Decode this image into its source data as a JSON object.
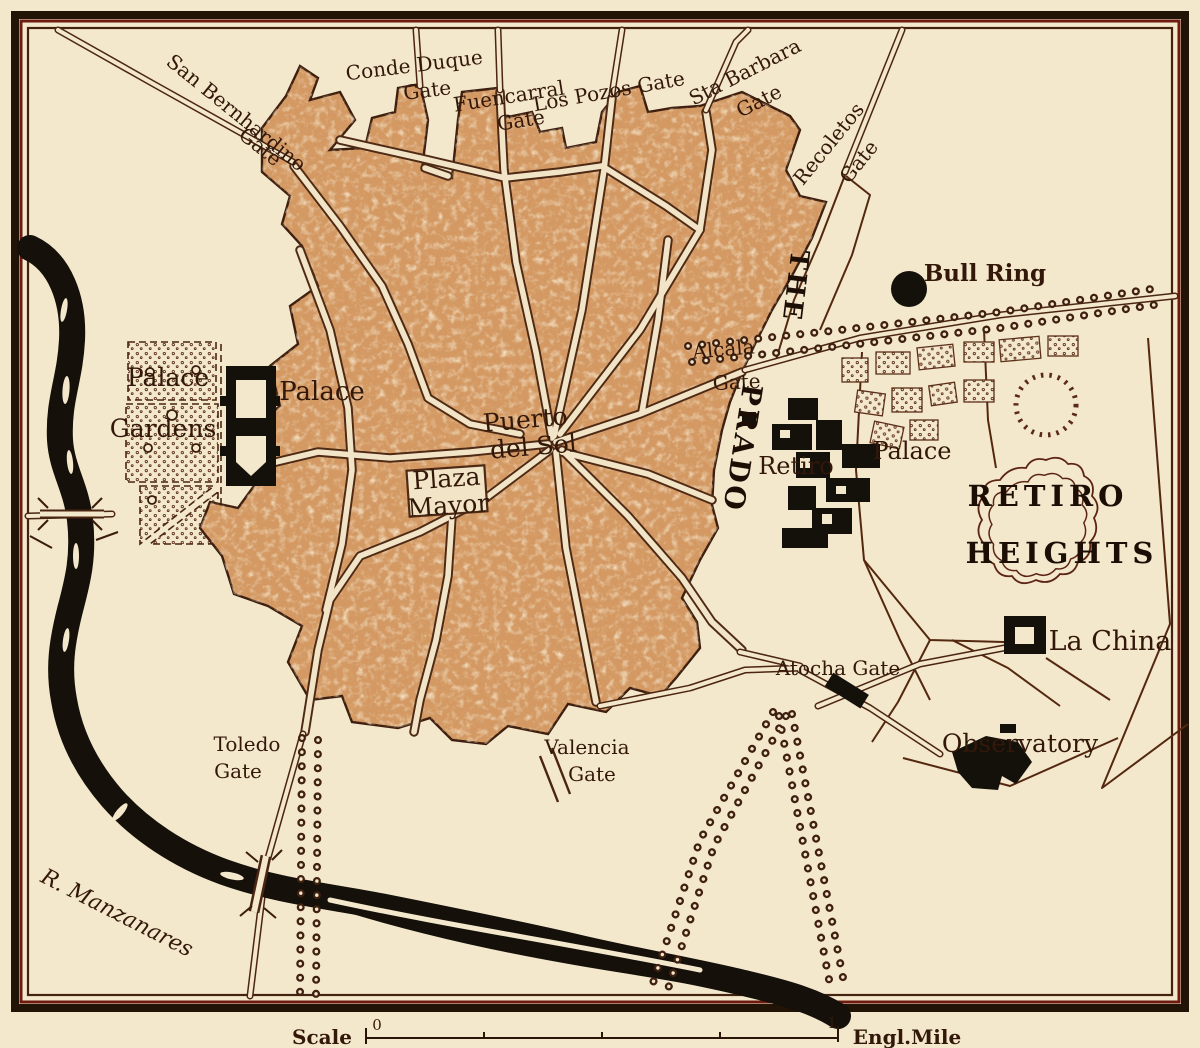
{
  "map": {
    "name": "vintage-map-of-madrid",
    "colors": {
      "paper": "#f3e7cc",
      "city_fill": "#d49963",
      "ink": "#3f2213",
      "black": "#171009",
      "maroon": "#6e1a10"
    },
    "gates": {
      "conde_duque_1": "Conde Duque",
      "conde_duque_2": "Gate",
      "fuencarral_1": "Fuencarral",
      "fuencarral_2": "Gate",
      "los_pozos": "Los Pozos Gate",
      "sta_barbara_1": "Sta Barbara",
      "sta_barbara_2": "Gate",
      "san_bernhardino_1": "San Bernhardino",
      "san_bernhardino_2": "Gate",
      "recoletos_1": "Recoletos",
      "recoletos_2": "Gate",
      "alcala_1": "Alcala",
      "alcala_2": "Gate",
      "atocha": "Atocha Gate",
      "toledo_1": "Toledo",
      "toledo_2": "Gate",
      "valencia_1": "Valencia",
      "valencia_2": "Gate"
    },
    "places": {
      "bull_ring": "Bull Ring",
      "the": "THE",
      "prado": "PRADO",
      "palace": "Palace",
      "palace_gardens_1": "Palace",
      "palace_gardens_2": "Gardens",
      "puerto_1": "Puerto",
      "puerto_2": "del Sol",
      "plaza_1": "Plaza",
      "plaza_2": "Mayor",
      "retiro_palace_1": "Retiro",
      "retiro_palace_2": "Palace",
      "retiro_heights_1": "RETIRO",
      "retiro_heights_2": "HEIGHTS",
      "la_china": "La China",
      "observatory": "Observatory",
      "river": "R. Manzanares"
    },
    "scale": {
      "label": "Scale",
      "zero": "0",
      "one": "1",
      "unit": "Engl.Mile"
    }
  }
}
